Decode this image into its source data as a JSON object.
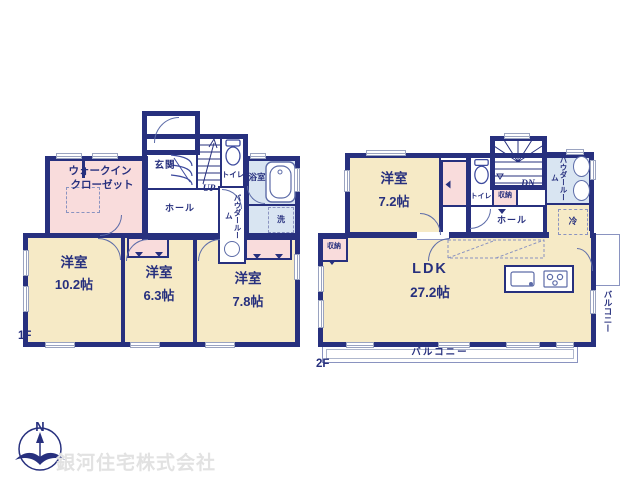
{
  "colors": {
    "wall_navy": "#27307E",
    "room_cream": "#F6EAC6",
    "closet_pink": "#F9DCDC",
    "bath_blue": "#D9E5F2",
    "fixture_line": "#5D6CA8",
    "watermark_gray": "#E2E2E2"
  },
  "compass": {
    "north": "N"
  },
  "watermark": "銀河住宅株式会社",
  "floor1": {
    "label": "1F",
    "entrance": "玄関",
    "stairs": "UP",
    "toilet": "トイレ",
    "bath": "浴室",
    "laundry": "洗",
    "powder_room": "パウダールーム",
    "hall": "ホール",
    "walk_in_closet": {
      "line1": "ウォークイン",
      "line2": "クローゼット"
    },
    "bedroom1": {
      "name": "洋室",
      "size": "10.2帖"
    },
    "bedroom2": {
      "name": "洋室",
      "size": "6.3帖"
    },
    "bedroom3": {
      "name": "洋室",
      "size": "7.8帖"
    }
  },
  "floor2": {
    "label": "2F",
    "bedroom": {
      "name": "洋室",
      "size": "7.2帖"
    },
    "toilet": "トイレ",
    "stairs": "DN",
    "storage_by_stairs": "収納",
    "powder_room": "パウダールーム",
    "hall": "ホール",
    "refrigerator": "冷",
    "storage_left": "収納",
    "ldk": {
      "name": "LDK",
      "size": "27.2帖"
    },
    "balcony_south": "バルコニー",
    "balcony_east": "バルコニー"
  }
}
